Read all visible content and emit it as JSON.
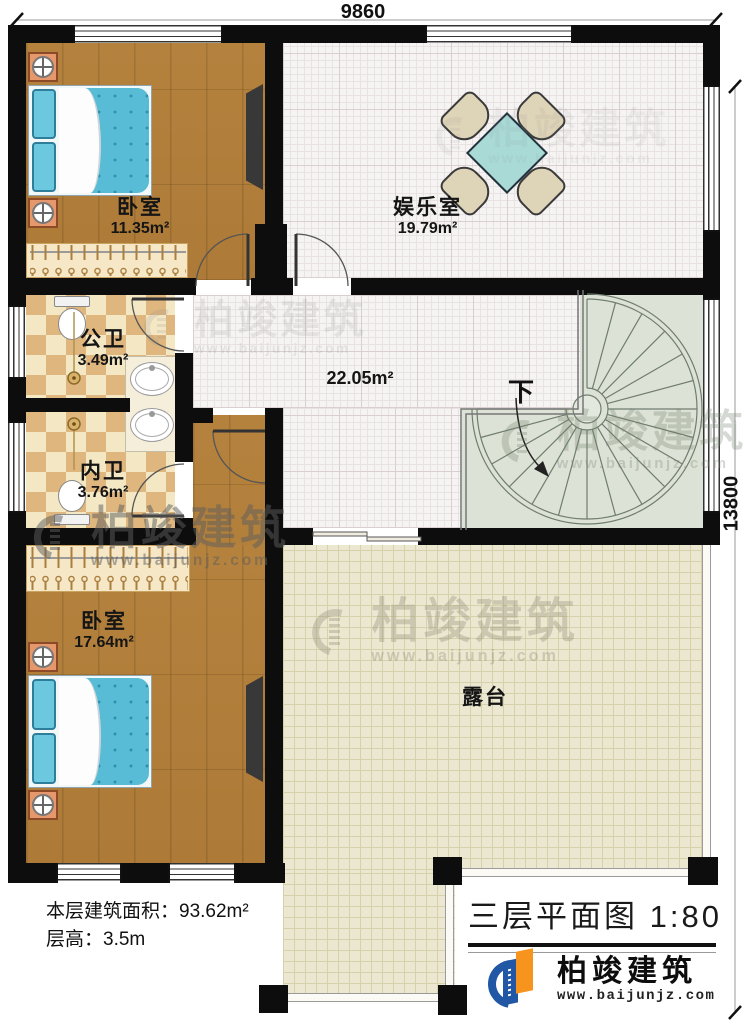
{
  "plan": {
    "dimension_top": "9860",
    "dimension_right": "13800",
    "rooms": {
      "bedroom_top": {
        "name": "卧室",
        "area": "11.35m²"
      },
      "entertainment": {
        "name": "娱乐室",
        "area": "19.79m²"
      },
      "public_bath": {
        "name": "公卫",
        "area": "3.49m²"
      },
      "private_bath": {
        "name": "内卫",
        "area": "3.76m²"
      },
      "bedroom_bottom": {
        "name": "卧室",
        "area": "17.64m²"
      },
      "hall": {
        "area": "22.05m²"
      },
      "terrace": {
        "name": "露台"
      },
      "stair": {
        "direction_label": "下"
      }
    }
  },
  "footer": {
    "building_area": "本层建筑面积：93.62m²",
    "floor_height": "层高：3.5m"
  },
  "title_block": {
    "title": "三层平面图",
    "scale": "1:80"
  },
  "brand": {
    "name": "柏竣建筑",
    "website": "www.baijunjz.com"
  },
  "watermark": {
    "name": "柏竣建筑",
    "website": "www.baijunjz.com"
  },
  "colors": {
    "wall": "#0d0d0d",
    "wood_floor": "#b5823e",
    "bath_tile": "#deb67e",
    "terrace_floor": "#ebe7d1",
    "stair_floor": "#dde2d7",
    "bed_blue": "#58bcd6",
    "brand_blue": "#2257a5",
    "brand_orange": "#f7941d"
  }
}
